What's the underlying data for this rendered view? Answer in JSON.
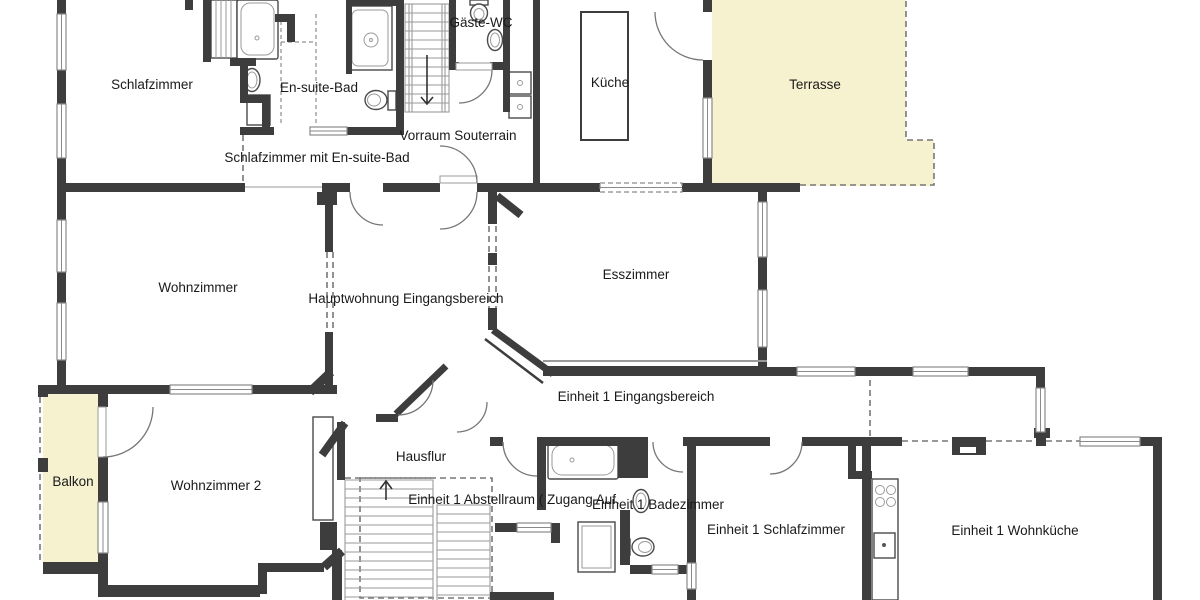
{
  "plan": {
    "type": "floor-plan",
    "language": "de",
    "rooms": [
      {
        "name": "schlafzimmer",
        "label": "Schlafzimmer"
      },
      {
        "name": "en-suite-bad",
        "label": "En-suite-Bad"
      },
      {
        "name": "gaeste-wc",
        "label": "Gäste-WC"
      },
      {
        "name": "schlafzimmer-mit-en-suite-bad",
        "label": "Schlafzimmer mit En-suite-Bad"
      },
      {
        "name": "vorraum-souterrain",
        "label": "Vorraum Souterrain"
      },
      {
        "name": "kueche",
        "label": "Küche"
      },
      {
        "name": "terrasse",
        "label": "Terrasse"
      },
      {
        "name": "wohnzimmer",
        "label": "Wohnzimmer"
      },
      {
        "name": "hauptwohnung-eingangsbereich",
        "label": "Hauptwohnung Eingangsbereich"
      },
      {
        "name": "esszimmer",
        "label": "Esszimmer"
      },
      {
        "name": "einheit-1-eingangsbereich",
        "label": "Einheit 1 Eingangsbereich"
      },
      {
        "name": "balkon",
        "label": "Balkon"
      },
      {
        "name": "wohnzimmer-2",
        "label": "Wohnzimmer 2"
      },
      {
        "name": "hausflur",
        "label": "Hausflur"
      },
      {
        "name": "einheit-1-abstellraum",
        "label": "Einheit 1 Abstellraum ( Zugang Auf."
      },
      {
        "name": "einheit-1-badezimmer",
        "label": "Einheit 1 Badezimmer"
      },
      {
        "name": "einheit-1-schlafzimmer",
        "label": "Einheit 1 Schlafzimmer"
      },
      {
        "name": "einheit-1-wohnkueche",
        "label": "Einheit 1 Wohnküche"
      }
    ],
    "colors": {
      "wall": "#3d3d3d",
      "outdoor": "#f6f2d0",
      "window_stroke": "#8a8a8a",
      "fixture": "#4a4a4a",
      "fixture_light": "#9a9a9a",
      "stair": "#9a9a9a",
      "dash": "#777777",
      "text": "#1a1a1a"
    }
  }
}
